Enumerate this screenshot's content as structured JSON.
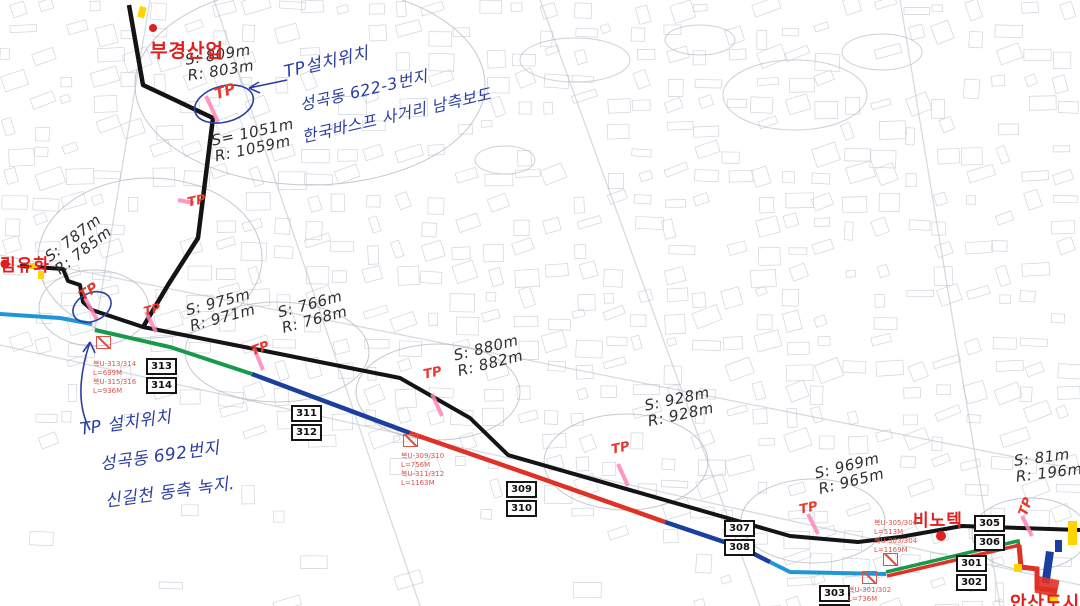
{
  "site_labels": {
    "bukyung": "부경산업",
    "limyuhwa": "림유화",
    "binotek": "비노텍",
    "ansan": "안산도시개"
  },
  "blue_notes": [
    {
      "lines": [
        "TP설치위치",
        "성곡동 622-3번지",
        "한국바스프 사거리 남측보도"
      ]
    },
    {
      "lines": [
        "TP 설치위치",
        "성곡동 692번지",
        "신길천 동측 녹지."
      ]
    }
  ],
  "measurements": [
    {
      "s": "S: 809m",
      "r": "R: 803m"
    },
    {
      "s": "S= 1051m",
      "r": "R: 1059m"
    },
    {
      "s": "S: 787m",
      "r": "R: 785m"
    },
    {
      "s": "S: 975m",
      "r": "R: 971m"
    },
    {
      "s": "S: 766m",
      "r": "R: 768m"
    },
    {
      "s": "S: 880m",
      "r": "R: 882m"
    },
    {
      "s": "S: 928m",
      "r": "R: 928m"
    },
    {
      "s": "S: 969m",
      "r": "R: 965m"
    },
    {
      "s": "S: 81m",
      "r": "R: 196m"
    }
  ],
  "tp_label": "TP",
  "route_markers": [
    {
      "top": "313",
      "bottom": "314"
    },
    {
      "top": "311",
      "bottom": "312"
    },
    {
      "top": "309",
      "bottom": "310"
    },
    {
      "top": "307",
      "bottom": "308"
    },
    {
      "top": "305",
      "bottom": "306"
    },
    {
      "top": "301",
      "bottom": "302"
    },
    {
      "top": "303",
      "bottom": "304"
    }
  ],
  "cable_labels": [
    {
      "lines": [
        "복U-313/314",
        "L=699M",
        "복U-315/316",
        "L=936M"
      ]
    },
    {
      "lines": [
        "복U-309/310",
        "L=756M",
        "복U-311/312",
        "L=1163M"
      ]
    },
    {
      "lines": [
        "복U-305/306",
        "L=513M",
        "복U-303/304",
        "L=1169M"
      ]
    },
    {
      "lines": [
        "복U-301/302",
        "L=736M",
        "",
        ""
      ]
    }
  ],
  "colors": {
    "route_black": "#141414",
    "route_green": "#169a4a",
    "route_navy": "#1b3f9e",
    "route_red": "#e03127",
    "route_cyan": "#2196d6",
    "tp_red": "#e8392e",
    "pen_blue": "#2a3fa0",
    "pen_black": "#2f2f2f",
    "label_red": "#e02020",
    "cable_red": "#d9554a",
    "highlight_pink": "#ff85b8",
    "highlight_yellow": "#ffd400",
    "map_line": "#b0b8c6"
  }
}
